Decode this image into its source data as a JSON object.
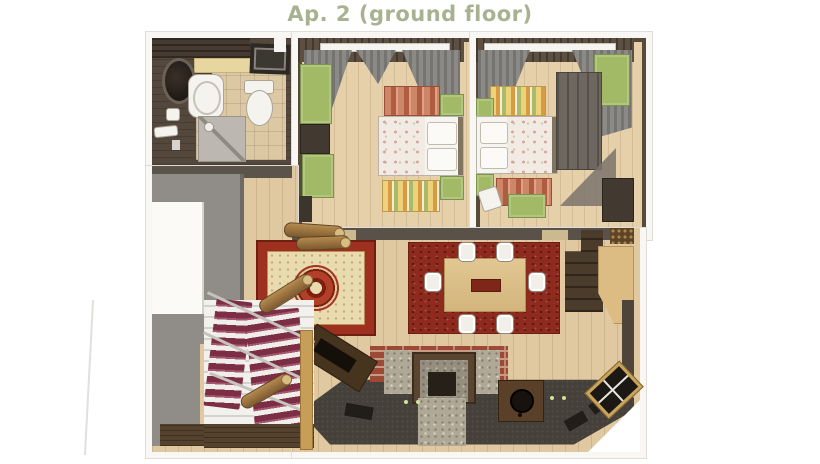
{
  "title": "Ap. 2 (ground floor)",
  "palette": {
    "title_text": "#a8b290",
    "exterior_wall": "#f8f7f4",
    "interior_wall_dark": "#5a5248",
    "hall_wall_gray": "#908d88",
    "wood_floor": "#e0c9a1",
    "bedroom_floor": "#e6d0aa",
    "bathroom_floor_dark": "#54473c",
    "bathroom_tile": "#dcc8a2",
    "furniture_green": "#a2b966",
    "wardrobe_gray": "#6e675f",
    "rug_red_stripe": "#b05c40",
    "rug_yellow_stripe": "#ecd27c",
    "persian_rug_red": "#9e3020",
    "persian_rug_field": "#e8dbae",
    "dining_rug_red": "#8e2b1e",
    "dining_table_wood": "#d3b57c",
    "brick_wall": "#9c4936",
    "stone_hearth": "#b0a897",
    "kitchen_counter_dark": "#45403a",
    "stair_runner_burgundy": "#7c2e47",
    "stair_step_white": "#f2f1ed",
    "railing_wood": "#c79e58"
  },
  "rooms": {
    "bathroom": {
      "items": [
        "round-mirror",
        "sink",
        "toilet",
        "washing-machine",
        "shower-tray",
        "bath-mat",
        "counter-strip"
      ]
    },
    "bedroom_1": {
      "items": [
        "window",
        "gray-curtains",
        "double-bed",
        "pillows",
        "striped-rug-red",
        "striped-rug-yellow",
        "nightstand-green-top",
        "nightstand-green-bottom",
        "wardrobe-green",
        "dark-cabinet",
        "bench-green",
        "door-opening"
      ]
    },
    "bedroom_2": {
      "items": [
        "window",
        "gray-curtains",
        "double-bed",
        "pillows",
        "striped-rug-yellow",
        "striped-rug-red",
        "nightstand-green-top",
        "nightstand-green-bottom",
        "dresser-green",
        "wardrobe-gray",
        "side-table-green",
        "dark-cabinet",
        "dropped-blanket"
      ]
    },
    "hallway": {
      "items": [
        "gray-wall",
        "entry-niche",
        "landing-planks"
      ]
    },
    "staircase": {
      "items": [
        "carpet-runner-left",
        "carpet-runner-right",
        "railings",
        "wood-handrail",
        "log-baluster",
        "landing"
      ]
    },
    "living_dining": {
      "items": [
        "firewood-logs",
        "persian-rug",
        "dining-rug",
        "dining-table",
        "centerpiece",
        "chair-x6",
        "corner-shelf-unit",
        "bar-counter",
        "wood-pile",
        "brick-wall",
        "stone-pillar-left",
        "stone-pillar-right",
        "fireplace",
        "stone-hearth",
        "kitchen-counter",
        "stove-box",
        "cooktop-hatches",
        "tv-cabinet",
        "corner-window"
      ]
    }
  }
}
